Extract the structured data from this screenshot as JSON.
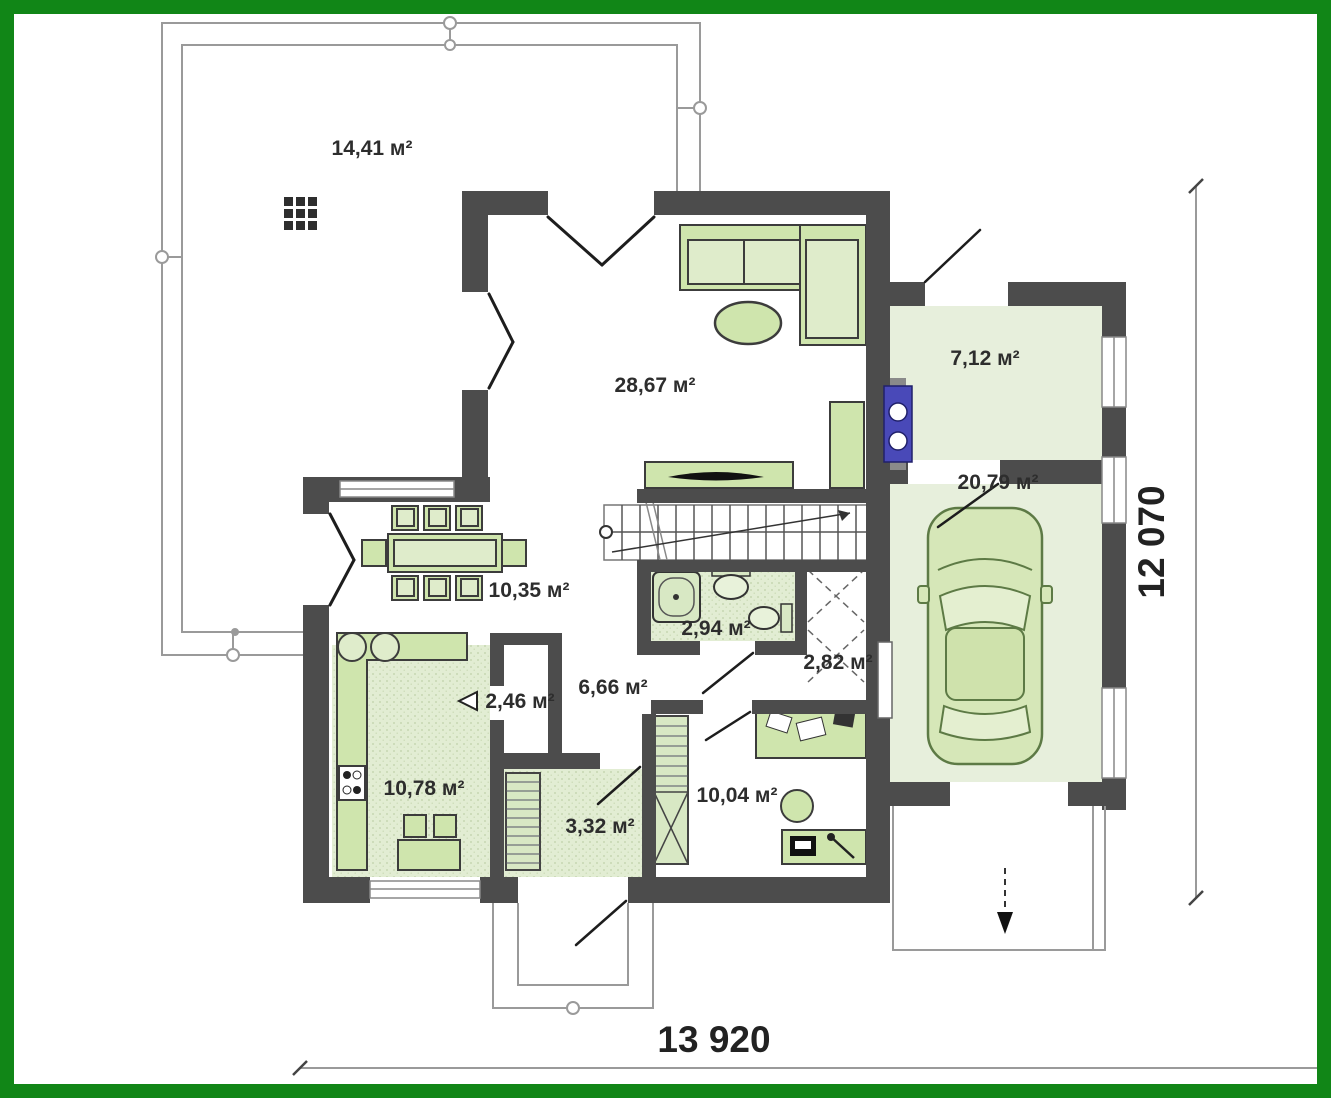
{
  "plan": {
    "rooms": [
      {
        "id": "terrace",
        "label": "14,41 м²"
      },
      {
        "id": "living",
        "label": "28,67 м²"
      },
      {
        "id": "technical",
        "label": "7,12 м²"
      },
      {
        "id": "garage",
        "label": "20,79 м²"
      },
      {
        "id": "dining",
        "label": "10,35 м²"
      },
      {
        "id": "bathroom",
        "label": "2,94 м²"
      },
      {
        "id": "wardrobe",
        "label": "2,82 м²"
      },
      {
        "id": "pantry",
        "label": "2,46 м²"
      },
      {
        "id": "hall",
        "label": "6,66 м²"
      },
      {
        "id": "kitchen",
        "label": "10,78 м²"
      },
      {
        "id": "laundry",
        "label": "3,32 м²"
      },
      {
        "id": "office",
        "label": "10,04 м²"
      }
    ],
    "dimensions": {
      "bottom": "13 920",
      "right": "12 070"
    },
    "colors": {
      "frame": "#118617",
      "wall": "#4c4c4c",
      "floor_green": "#e7efdc",
      "furniture_green": "#cfe5ad",
      "furniture_light": "#dfeccb",
      "boiler_blue": "#4949b8",
      "line_gray": "#9a9a9a"
    }
  }
}
